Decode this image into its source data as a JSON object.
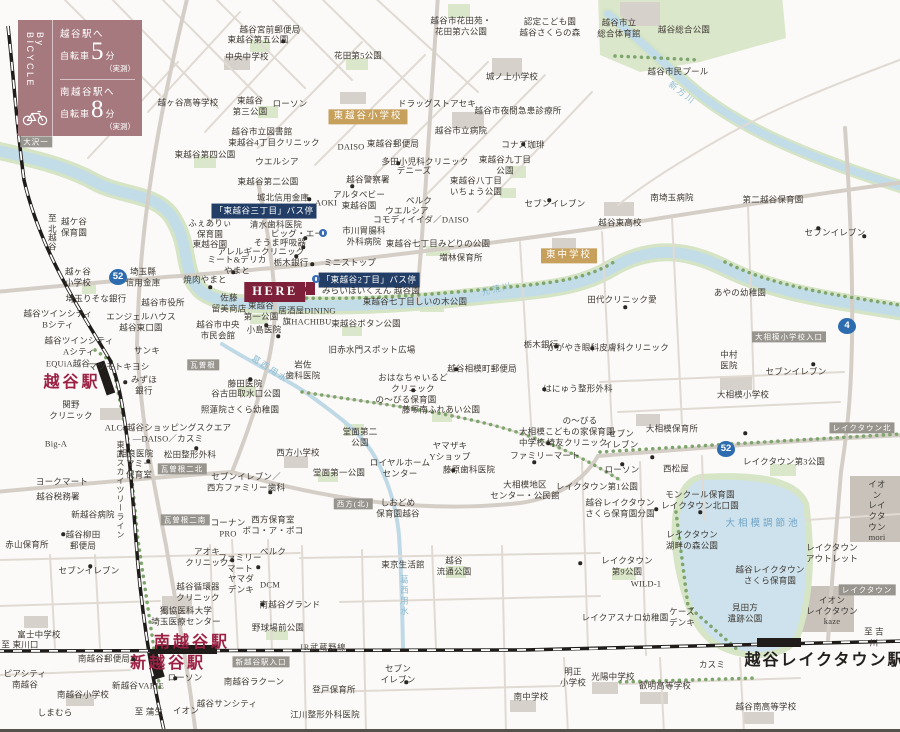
{
  "legend": {
    "vertical_label": "By BICYCLE",
    "entries": [
      {
        "to": "越谷駅へ",
        "mode": "自転車",
        "minutes": "5",
        "unit": "分",
        "note": "（実測）"
      },
      {
        "to": "南越谷駅へ",
        "mode": "自転車",
        "minutes": "8",
        "unit": "分",
        "note": "（実測）"
      }
    ]
  },
  "here": {
    "label": "HERE"
  },
  "colors": {
    "legend_bg": "#a6797e",
    "here_bg": "#7e2039",
    "bus_stop_bg": "#223d66",
    "school_badge_bg": "#c7a05b",
    "road_badge_bg": "#98948e",
    "route_shield_bg": "#2e6cb0",
    "station_text": "#9c2144",
    "river": "#c2dde8",
    "park": "#dbe7cb",
    "lake": "#cde2ec"
  },
  "map": {
    "labels": [
      {
        "x": 270,
        "y": 30,
        "t": "越谷宮前郵便局"
      },
      {
        "x": 258,
        "y": 40,
        "t": "東越谷第五公園"
      },
      {
        "x": 247,
        "y": 57,
        "t": "中央中学校"
      },
      {
        "x": 188,
        "y": 103,
        "t": "越ヶ谷高等学校"
      },
      {
        "x": 250,
        "y": 106,
        "t": "東越谷\n第三公園"
      },
      {
        "x": 290,
        "y": 104,
        "t": "ローソン"
      },
      {
        "x": 262,
        "y": 132,
        "t": "越谷市立図書館"
      },
      {
        "x": 274,
        "y": 143,
        "t": "東越谷4丁目クリニック"
      },
      {
        "x": 205,
        "y": 155,
        "t": "東越谷第四公園"
      },
      {
        "x": 36,
        "y": 142,
        "t": "大沢一",
        "c": "bdg"
      },
      {
        "x": 277,
        "y": 162,
        "t": "ウエルシア"
      },
      {
        "x": 268,
        "y": 182,
        "t": "東越谷第二公園"
      },
      {
        "x": 283,
        "y": 198,
        "t": "城北信用金庫"
      },
      {
        "x": 461,
        "y": 26,
        "t": "越谷市花田苑・\n花田第六公園"
      },
      {
        "x": 550,
        "y": 27,
        "t": "認定こども園\n越谷さくらの森"
      },
      {
        "x": 358,
        "y": 56,
        "t": "花田第5公園"
      },
      {
        "x": 512,
        "y": 77,
        "t": "城ノ上小学校"
      },
      {
        "x": 437,
        "y": 104,
        "t": "ドラッグストアセキ"
      },
      {
        "x": 518,
        "y": 111,
        "t": "越谷市夜間急患診療所"
      },
      {
        "x": 368,
        "y": 117,
        "t": "東越谷小学校",
        "c": "tan"
      },
      {
        "x": 461,
        "y": 131,
        "t": "越谷市立病院"
      },
      {
        "x": 351,
        "y": 147,
        "t": "DAISO"
      },
      {
        "x": 393,
        "y": 144,
        "t": "東越谷郵便局"
      },
      {
        "x": 523,
        "y": 145,
        "t": "コナズ珈琲"
      },
      {
        "x": 425,
        "y": 162,
        "t": "多田小児科クリニック"
      },
      {
        "x": 505,
        "y": 165,
        "t": "東越谷九丁目\n公園"
      },
      {
        "x": 414,
        "y": 171,
        "t": "デニーズ"
      },
      {
        "x": 368,
        "y": 180,
        "t": "越谷警察署"
      },
      {
        "x": 476,
        "y": 186,
        "t": "東越谷八丁目\nいちょう公園"
      },
      {
        "x": 555,
        "y": 204,
        "t": "セブンイレブン"
      },
      {
        "x": 619,
        "y": 28,
        "t": "越谷市立\n総合体育館"
      },
      {
        "x": 684,
        "y": 30,
        "t": "越谷総合公園"
      },
      {
        "x": 678,
        "y": 72,
        "t": "越谷市民プール"
      },
      {
        "x": 682,
        "y": 93,
        "t": "新方川",
        "c": "riv",
        "r": 38
      },
      {
        "x": 52,
        "y": 232,
        "t": "至 北越谷",
        "v": 1
      },
      {
        "x": 74,
        "y": 227,
        "t": "越ケ谷\n保育園"
      },
      {
        "x": 78,
        "y": 277,
        "t": "越ヶ谷\n小学校"
      },
      {
        "x": 118,
        "y": 277,
        "t": "52",
        "c": "shield"
      },
      {
        "x": 143,
        "y": 277,
        "t": "埼玉縣\n信用金庫"
      },
      {
        "x": 96,
        "y": 299,
        "t": "埼玉りそな銀行"
      },
      {
        "x": 163,
        "y": 303,
        "t": "越谷市役所"
      },
      {
        "x": 58,
        "y": 319,
        "t": "越谷ツインシティ\nBシティ"
      },
      {
        "x": 141,
        "y": 322,
        "t": "エンジェルハウス\n越谷東口園"
      },
      {
        "x": 79,
        "y": 346,
        "t": "越谷ツインシティ\nAシティ"
      },
      {
        "x": 147,
        "y": 351,
        "t": "サンキ"
      },
      {
        "x": 264,
        "y": 211,
        "t": "「東越谷三丁目」バス停",
        "c": "bus"
      },
      {
        "x": 210,
        "y": 234,
        "t": "ふぇありぃ\n保育園\n東越谷園"
      },
      {
        "x": 276,
        "y": 225,
        "t": "清水歯科医院"
      },
      {
        "x": 297,
        "y": 234,
        "t": "ビッグ・エー"
      },
      {
        "x": 280,
        "y": 243,
        "t": "そうま呼吸器"
      },
      {
        "x": 261,
        "y": 252,
        "t": "アレルギークリニック"
      },
      {
        "x": 237,
        "y": 265,
        "t": "ミート&デリカ\nやまと"
      },
      {
        "x": 291,
        "y": 263,
        "t": "栃木銀行"
      },
      {
        "x": 350,
        "y": 263,
        "t": "ミニストップ"
      },
      {
        "x": 205,
        "y": 280,
        "t": "焼肉やまと"
      },
      {
        "x": 369,
        "y": 280,
        "t": "「東越谷2丁目」バス停",
        "c": "bus"
      },
      {
        "x": 371,
        "y": 291,
        "t": "みらいほいくえん 越谷園"
      },
      {
        "x": 229,
        "y": 303,
        "t": "佐藤\n留美商店"
      },
      {
        "x": 261,
        "y": 311,
        "t": "東越谷\n第一公園"
      },
      {
        "x": 307,
        "y": 316,
        "t": "居酒屋DINING\n旗HACHIBU"
      },
      {
        "x": 264,
        "y": 330,
        "t": "小島医院"
      },
      {
        "x": 218,
        "y": 330,
        "t": "越谷市中央\n市民会館"
      },
      {
        "x": 359,
        "y": 200,
        "t": "アルタベビー\n東越谷園"
      },
      {
        "x": 326,
        "y": 203,
        "t": "AOKI"
      },
      {
        "x": 419,
        "y": 201,
        "t": "ベルク"
      },
      {
        "x": 407,
        "y": 211,
        "t": "ウエルシア"
      },
      {
        "x": 421,
        "y": 220,
        "t": "コモディイイダ／DAISO"
      },
      {
        "x": 364,
        "y": 236,
        "t": "市川胃腸科\n外科病院"
      },
      {
        "x": 438,
        "y": 244,
        "t": "東越谷七丁目みどりの公園"
      },
      {
        "x": 461,
        "y": 258,
        "t": "増林保育所"
      },
      {
        "x": 569,
        "y": 256,
        "t": "東中学校",
        "c": "tan"
      },
      {
        "x": 497,
        "y": 289,
        "t": "元荒川",
        "c": "riv",
        "r": -14
      },
      {
        "x": 415,
        "y": 302,
        "t": "東越谷七丁目しいの木公園"
      },
      {
        "x": 366,
        "y": 324,
        "t": "東越谷ボタン公園"
      },
      {
        "x": 372,
        "y": 350,
        "t": "旧赤水門スポット広場"
      },
      {
        "x": 541,
        "y": 345,
        "t": "栃木銀行"
      },
      {
        "x": 608,
        "y": 348,
        "t": "かがやき眼科皮膚科クリニック"
      },
      {
        "x": 672,
        "y": 198,
        "t": "南埼玉病院"
      },
      {
        "x": 773,
        "y": 200,
        "t": "第二越谷保育園"
      },
      {
        "x": 620,
        "y": 223,
        "t": "越谷東高校"
      },
      {
        "x": 835,
        "y": 233,
        "t": "セブンイレブン"
      },
      {
        "x": 622,
        "y": 300,
        "t": "田代クリニック愛"
      },
      {
        "x": 740,
        "y": 293,
        "t": "あやの幼稚園"
      },
      {
        "x": 789,
        "y": 337,
        "t": "大相模小学校入口",
        "c": "bdg"
      },
      {
        "x": 729,
        "y": 360,
        "t": "中村\n医院"
      },
      {
        "x": 847,
        "y": 326,
        "t": "4",
        "c": "shield"
      },
      {
        "x": 796,
        "y": 372,
        "t": "セブンイレブン"
      },
      {
        "x": 578,
        "y": 389,
        "t": "はにゅう整形外科"
      },
      {
        "x": 68,
        "y": 364,
        "t": "EQUiA越谷"
      },
      {
        "x": 72,
        "y": 383,
        "t": "越谷駅",
        "c": "sta"
      },
      {
        "x": 119,
        "y": 367,
        "t": "マツモトキヨシ"
      },
      {
        "x": 144,
        "y": 385,
        "t": "みずほ\n銀行"
      },
      {
        "x": 71,
        "y": 410,
        "t": "関野\nクリニック"
      },
      {
        "x": 56,
        "y": 444,
        "t": "Big-A"
      },
      {
        "x": 62,
        "y": 482,
        "t": "ヨークマート"
      },
      {
        "x": 58,
        "y": 497,
        "t": "越谷税務署"
      },
      {
        "x": 93,
        "y": 515,
        "t": "新越谷病院"
      },
      {
        "x": 168,
        "y": 433,
        "t": "ALCo越谷ショッピングスクエア\n―DAISO／カスミ"
      },
      {
        "x": 136,
        "y": 454,
        "t": "相良医院"
      },
      {
        "x": 139,
        "y": 469,
        "t": "マミー\n保育室"
      },
      {
        "x": 190,
        "y": 455,
        "t": "松田整形外科"
      },
      {
        "x": 203,
        "y": 365,
        "t": "瓦曽根",
        "c": "bdg"
      },
      {
        "x": 182,
        "y": 469,
        "t": "瓦曽根二北",
        "c": "bdg"
      },
      {
        "x": 185,
        "y": 520,
        "t": "瓦曽根二南",
        "c": "bdg"
      },
      {
        "x": 245,
        "y": 384,
        "t": "藤田医院"
      },
      {
        "x": 246,
        "y": 394,
        "t": "谷古田取水口公園"
      },
      {
        "x": 240,
        "y": 410,
        "t": "照蓮院さくら幼稚園"
      },
      {
        "x": 270,
        "y": 369,
        "t": "葛西用水",
        "c": "riv",
        "r": 33
      },
      {
        "x": 246,
        "y": 482,
        "t": "セブンイレブン／\n西方ファミリー歯科"
      },
      {
        "x": 228,
        "y": 528,
        "t": "コーナン\nPRO"
      },
      {
        "x": 273,
        "y": 525,
        "t": "西方保育室\nポコ・ア・ポコ"
      },
      {
        "x": 120,
        "y": 490,
        "t": "東武スカイツリーライン",
        "v": 1,
        "c": "rail"
      },
      {
        "x": 303,
        "y": 370,
        "t": "岩佐\n歯科医院"
      },
      {
        "x": 298,
        "y": 453,
        "t": "西方小学校"
      },
      {
        "x": 413,
        "y": 383,
        "t": "おはなちゃいるど\nクリニック"
      },
      {
        "x": 406,
        "y": 400,
        "t": "の〜びる保育園"
      },
      {
        "x": 441,
        "y": 410,
        "t": "藤塚南ふれあい公園"
      },
      {
        "x": 482,
        "y": 369,
        "t": "越谷相模町郵便局"
      },
      {
        "x": 360,
        "y": 437,
        "t": "堂面第二\n公園"
      },
      {
        "x": 339,
        "y": 473,
        "t": "堂面第一公園"
      },
      {
        "x": 450,
        "y": 451,
        "t": "ヤマザキ\nYショップ"
      },
      {
        "x": 400,
        "y": 468,
        "t": "ロイヤルホーム\nセンター"
      },
      {
        "x": 469,
        "y": 470,
        "t": "藤原歯科医院"
      },
      {
        "x": 353,
        "y": 504,
        "t": "西方(北)",
        "c": "bdg"
      },
      {
        "x": 398,
        "y": 508,
        "t": "しおどめ\n保育園越谷"
      },
      {
        "x": 532,
        "y": 437,
        "t": "大相模\n中学校"
      },
      {
        "x": 580,
        "y": 426,
        "t": "の〜びる\nこどもの家保育園"
      },
      {
        "x": 577,
        "y": 443,
        "t": "埼友クリニック"
      },
      {
        "x": 545,
        "y": 456,
        "t": "ファミリーマート"
      },
      {
        "x": 525,
        "y": 490,
        "t": "大相模地区\nセンター・公民館"
      },
      {
        "x": 672,
        "y": 429,
        "t": "大相模保育所"
      },
      {
        "x": 621,
        "y": 439,
        "t": "セブン\nイレブン"
      },
      {
        "x": 743,
        "y": 395,
        "t": "大相模小学校"
      },
      {
        "x": 726,
        "y": 449,
        "t": "52",
        "c": "shield"
      },
      {
        "x": 862,
        "y": 428,
        "t": "レイクタウン北",
        "c": "bdg"
      },
      {
        "x": 622,
        "y": 470,
        "t": "ローソン"
      },
      {
        "x": 676,
        "y": 469,
        "t": "西松屋"
      },
      {
        "x": 784,
        "y": 462,
        "t": "レイクタウン第3公園"
      },
      {
        "x": 597,
        "y": 487,
        "t": "レイクタウン第1公園"
      },
      {
        "x": 700,
        "y": 500,
        "t": "モンクール保育園\nレイクタウン北口園"
      },
      {
        "x": 620,
        "y": 508,
        "t": "越谷レイクタウン\nさくら保育園分園"
      },
      {
        "x": 877,
        "y": 511,
        "t": "イオン\nレイクタウン\nmori"
      },
      {
        "x": 763,
        "y": 525,
        "t": "大相模調節池",
        "c": "lake"
      },
      {
        "x": 27,
        "y": 545,
        "t": "赤山保育所"
      },
      {
        "x": 83,
        "y": 540,
        "t": "越谷柳田\n郵便局"
      },
      {
        "x": 89,
        "y": 571,
        "t": "セブンイレブン"
      },
      {
        "x": 39,
        "y": 635,
        "t": "富士中学校"
      },
      {
        "x": 20,
        "y": 645,
        "t": "至 東川口"
      },
      {
        "x": 207,
        "y": 557,
        "t": "アオキ\nクリニック"
      },
      {
        "x": 240,
        "y": 563,
        "t": "ファミリー\nマート"
      },
      {
        "x": 273,
        "y": 552,
        "t": "ベルク"
      },
      {
        "x": 241,
        "y": 584,
        "t": "ヤマダ\nデンキ"
      },
      {
        "x": 270,
        "y": 585,
        "t": "DCM"
      },
      {
        "x": 198,
        "y": 592,
        "t": "越谷循環器\nクリニック"
      },
      {
        "x": 186,
        "y": 616,
        "t": "獨協医科大学\n埼玉医療センター"
      },
      {
        "x": 290,
        "y": 605,
        "t": "南越谷グランド"
      },
      {
        "x": 278,
        "y": 628,
        "t": "野球場前公園"
      },
      {
        "x": 192,
        "y": 643,
        "t": "南越谷駅",
        "c": "sta"
      },
      {
        "x": 168,
        "y": 664,
        "t": "新越谷駅",
        "c": "sta"
      },
      {
        "x": 104,
        "y": 659,
        "t": "南越谷郵便局"
      },
      {
        "x": 261,
        "y": 662,
        "t": "新越谷駅入口",
        "c": "bdg"
      },
      {
        "x": 25,
        "y": 679,
        "t": "ピアシティ\n南越谷"
      },
      {
        "x": 83,
        "y": 695,
        "t": "南越谷小学校"
      },
      {
        "x": 138,
        "y": 686,
        "t": "新越谷VARIE"
      },
      {
        "x": 185,
        "y": 678,
        "t": "ローソン"
      },
      {
        "x": 254,
        "y": 682,
        "t": "南越谷ラクーン"
      },
      {
        "x": 55,
        "y": 713,
        "t": "しまむら"
      },
      {
        "x": 149,
        "y": 712,
        "t": "至 蒲生"
      },
      {
        "x": 186,
        "y": 711,
        "t": "イオン"
      },
      {
        "x": 227,
        "y": 704,
        "t": "越谷サンシティ"
      },
      {
        "x": 323,
        "y": 648,
        "t": "JR武蔵野線",
        "c": "rail"
      },
      {
        "x": 403,
        "y": 565,
        "t": "東京生活館"
      },
      {
        "x": 454,
        "y": 566,
        "t": "越谷\n流通公園"
      },
      {
        "x": 404,
        "y": 596,
        "t": "葛西用水",
        "c": "riv",
        "v": 1
      },
      {
        "x": 398,
        "y": 674,
        "t": "セブン\nイレブン"
      },
      {
        "x": 334,
        "y": 690,
        "t": "登戸保育所"
      },
      {
        "x": 325,
        "y": 715,
        "t": "江川整形外科医院"
      },
      {
        "x": 531,
        "y": 697,
        "t": "南中学校"
      },
      {
        "x": 573,
        "y": 677,
        "t": "明正\n小学校"
      },
      {
        "x": 613,
        "y": 677,
        "t": "光陽中学校"
      },
      {
        "x": 692,
        "y": 540,
        "t": "レイクタウン\n湖畔の森公園"
      },
      {
        "x": 627,
        "y": 566,
        "t": "レイクタウン\n第9公園"
      },
      {
        "x": 646,
        "y": 584,
        "t": "WILD-1"
      },
      {
        "x": 770,
        "y": 575,
        "t": "越谷レイクタウン\nさくら保育園"
      },
      {
        "x": 832,
        "y": 553,
        "t": "レイクタウン\nアウトレット"
      },
      {
        "x": 867,
        "y": 590,
        "t": "レイクタウン",
        "c": "bdg"
      },
      {
        "x": 832,
        "y": 611,
        "t": "イオン\nレイクタウン\nkaze"
      },
      {
        "x": 874,
        "y": 637,
        "t": "至 吉川"
      },
      {
        "x": 825,
        "y": 661,
        "t": "越谷レイクタウン駅",
        "c": "stab"
      },
      {
        "x": 682,
        "y": 617,
        "t": "ケーズ\nデンキ"
      },
      {
        "x": 745,
        "y": 613,
        "t": "見田方\n遺跡公園"
      },
      {
        "x": 625,
        "y": 618,
        "t": "レイクアスナロ幼稚園"
      },
      {
        "x": 712,
        "y": 665,
        "t": "カスミ"
      },
      {
        "x": 665,
        "y": 686,
        "t": "叡明高等学校"
      },
      {
        "x": 766,
        "y": 707,
        "t": "越谷南高等学校"
      }
    ],
    "dots": [
      [
        283,
        41
      ],
      [
        523,
        144
      ],
      [
        398,
        163
      ],
      [
        352,
        186
      ],
      [
        549,
        200
      ],
      [
        309,
        199
      ],
      [
        305,
        238
      ],
      [
        303,
        247
      ],
      [
        296,
        256
      ],
      [
        312,
        264
      ],
      [
        233,
        272
      ],
      [
        210,
        287
      ],
      [
        266,
        325
      ],
      [
        278,
        336
      ],
      [
        556,
        346
      ],
      [
        592,
        348
      ],
      [
        625,
        307
      ],
      [
        818,
        228
      ],
      [
        813,
        364
      ],
      [
        544,
        389
      ],
      [
        652,
        457
      ],
      [
        548,
        443
      ],
      [
        534,
        462
      ],
      [
        453,
        470
      ],
      [
        413,
        390
      ],
      [
        456,
        369
      ],
      [
        125,
        382
      ],
      [
        148,
        461
      ],
      [
        196,
        448
      ],
      [
        250,
        379
      ],
      [
        270,
        492
      ],
      [
        90,
        566
      ],
      [
        63,
        534
      ],
      [
        175,
        678
      ],
      [
        133,
        659
      ],
      [
        232,
        560
      ],
      [
        258,
        567
      ],
      [
        262,
        604
      ],
      [
        580,
        563
      ],
      [
        406,
        682
      ],
      [
        745,
        433
      ],
      [
        622,
        464
      ],
      [
        864,
        236
      ],
      [
        700,
        512
      ],
      [
        656,
        509
      ]
    ],
    "bus_icons": [
      [
        323,
        233
      ],
      [
        316,
        279
      ]
    ]
  }
}
